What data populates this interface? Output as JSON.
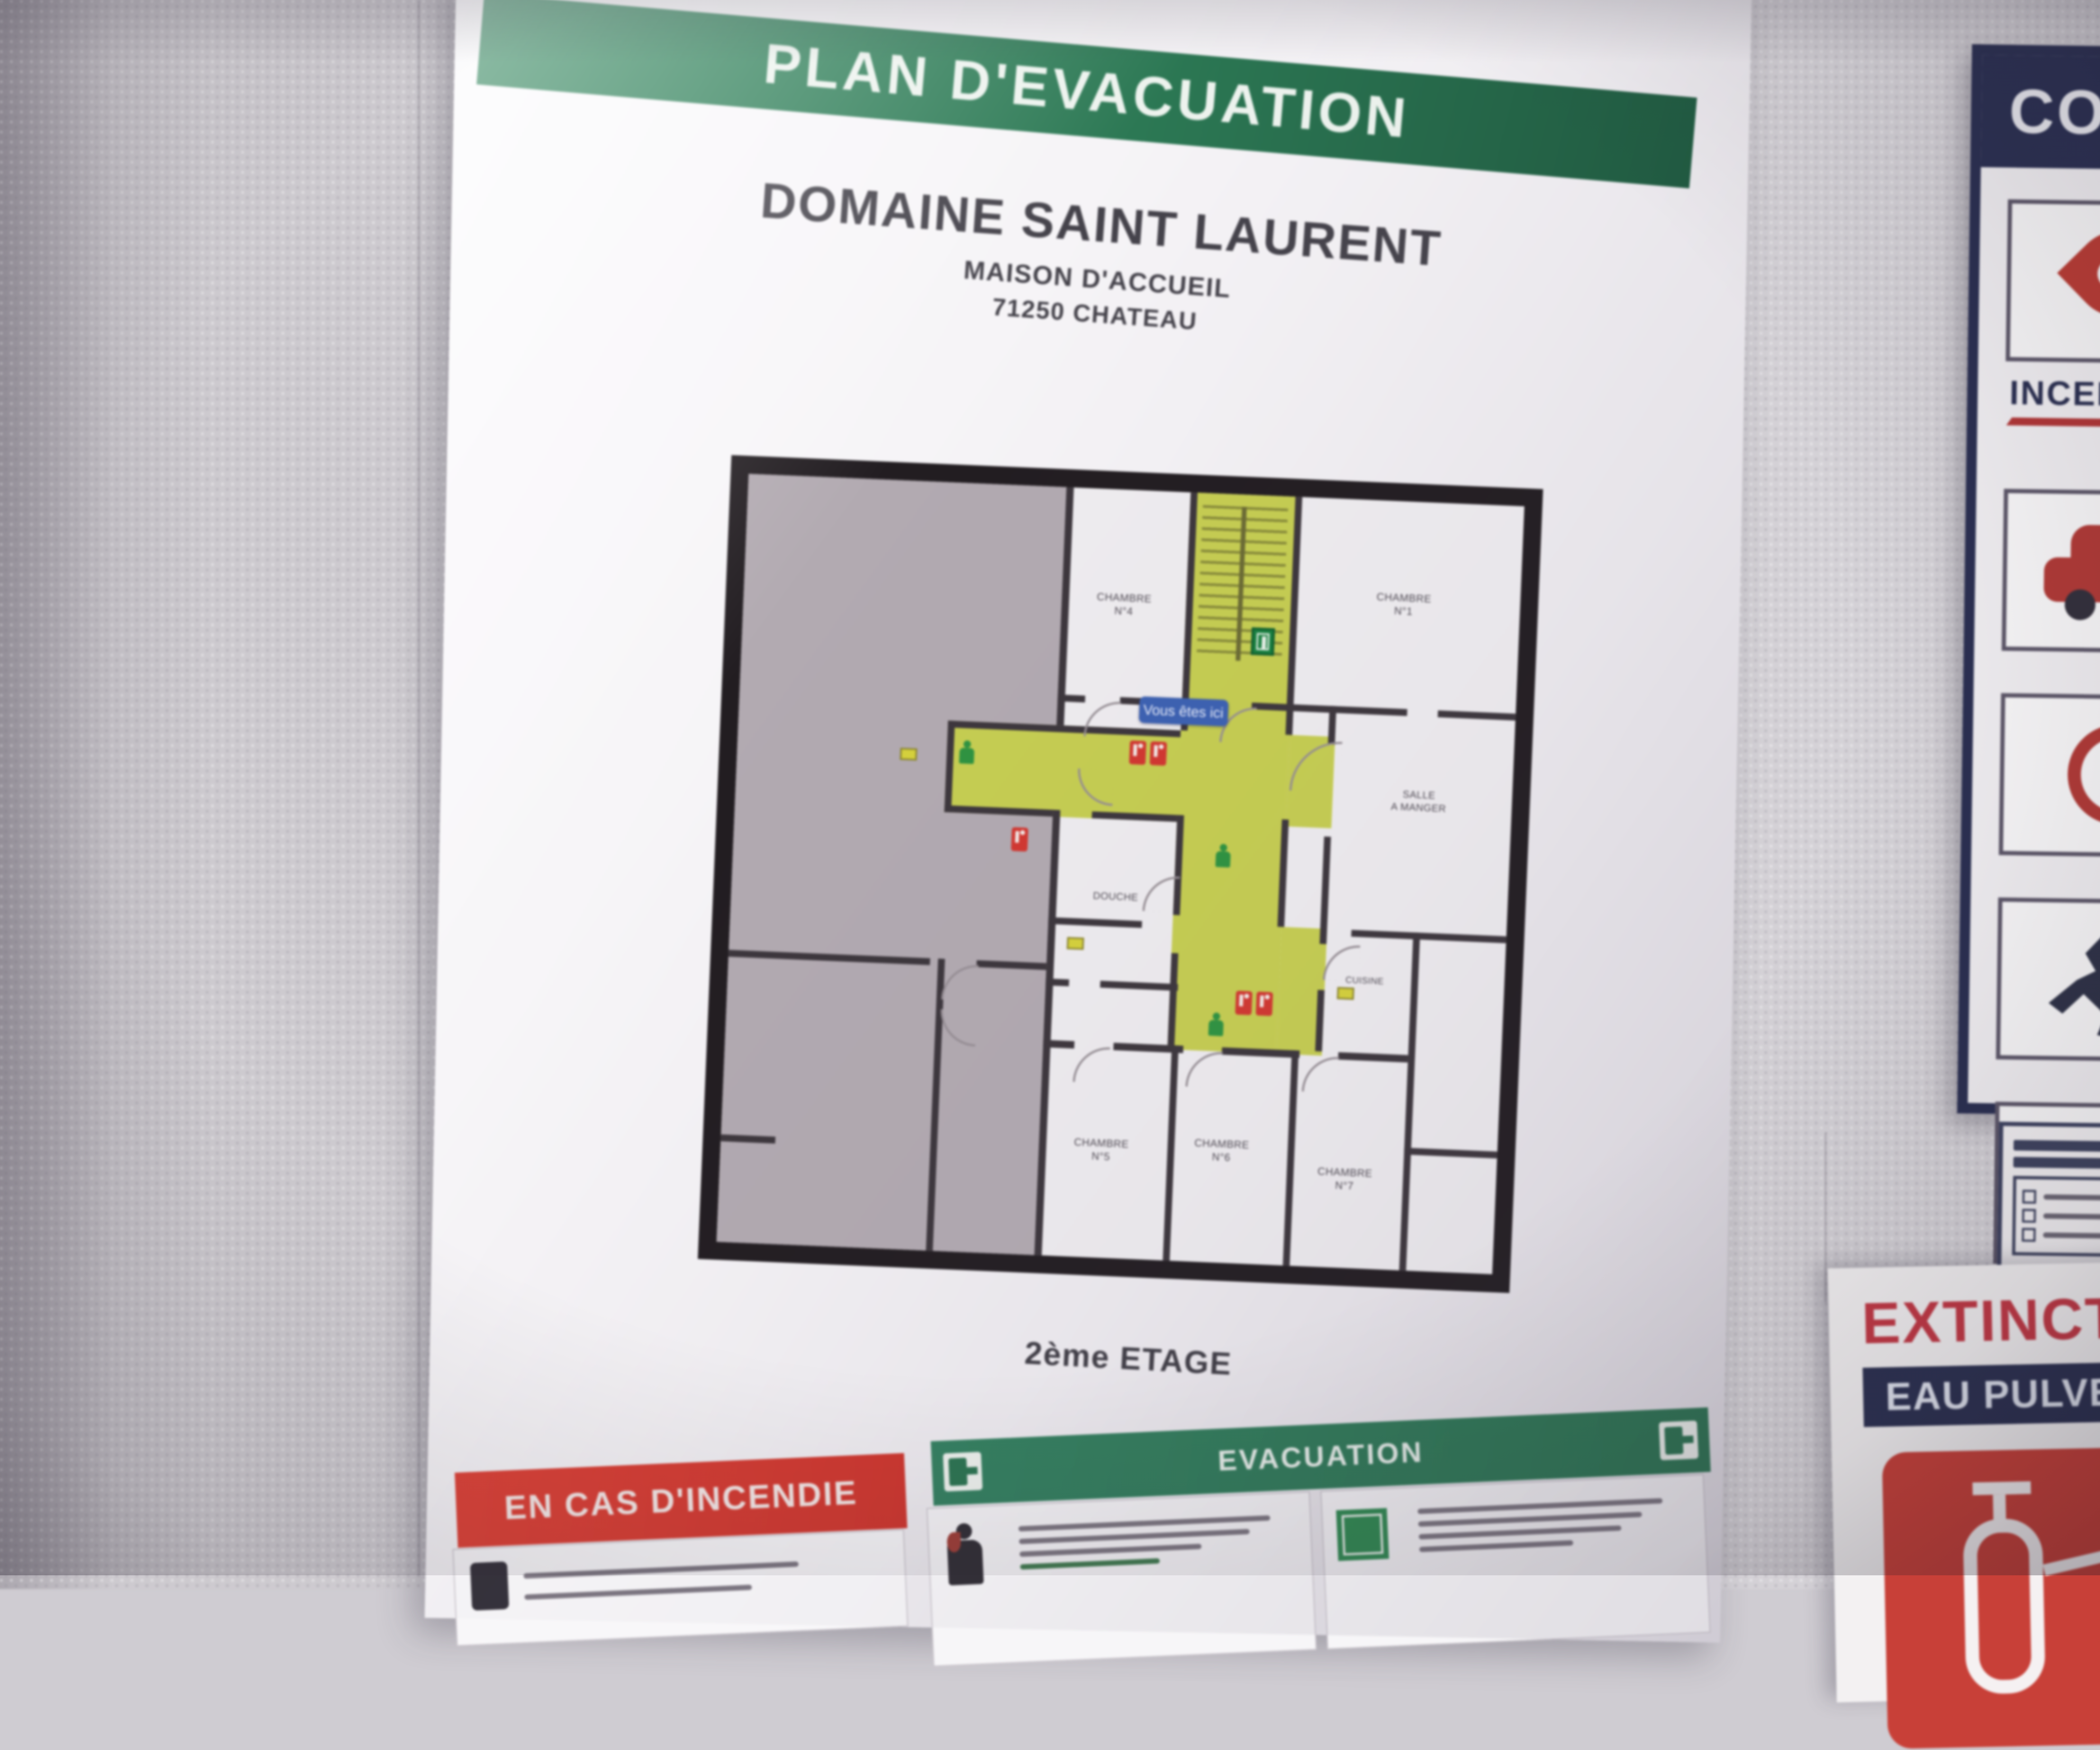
{
  "poster": {
    "banner_title": "PLAN D'EVACUATION",
    "site": {
      "name": "DOMAINE SAINT LAURENT",
      "subtitle": "MAISON D'ACCUEIL",
      "city": "71250 CHATEAU"
    },
    "floor_label": "2ème ETAGE",
    "plan": {
      "you_are_here": "Vous êtes ici",
      "rooms": {
        "chambre_top_left": {
          "line1": "CHAMBRE",
          "line2": "N°4"
        },
        "chambre_top_right": {
          "line1": "CHAMBRE",
          "line2": "N°1"
        },
        "salle": {
          "line1": "SALLE",
          "line2": "A MANGER"
        },
        "douche": {
          "line1": "DOUCHE"
        },
        "cuisine": {
          "line1": "CUISINE"
        },
        "chambre_b1": {
          "line1": "CHAMBRE",
          "line2": "N°5"
        },
        "chambre_b2": {
          "line1": "CHAMBRE",
          "line2": "N°6"
        },
        "chambre_b3": {
          "line1": "CHAMBRE",
          "line2": "N°7"
        }
      }
    },
    "instructions": {
      "fire_title": "EN CAS D'INCENDIE",
      "evac_title": "EVACUATION"
    }
  },
  "wall_posters": {
    "consignes": {
      "title": "CONSIGNES",
      "subtitle": "INCENDIE"
    },
    "extincteur": {
      "title": "EXTINCTEUR",
      "subtitle": "EAU PULVERISEE"
    }
  },
  "colors": {
    "banner_green": "#2e7c57",
    "alert_red": "#d63a30",
    "corridor_yellow": "#c6ce51",
    "navy": "#2a2f51",
    "poster_red": "#c23844"
  }
}
